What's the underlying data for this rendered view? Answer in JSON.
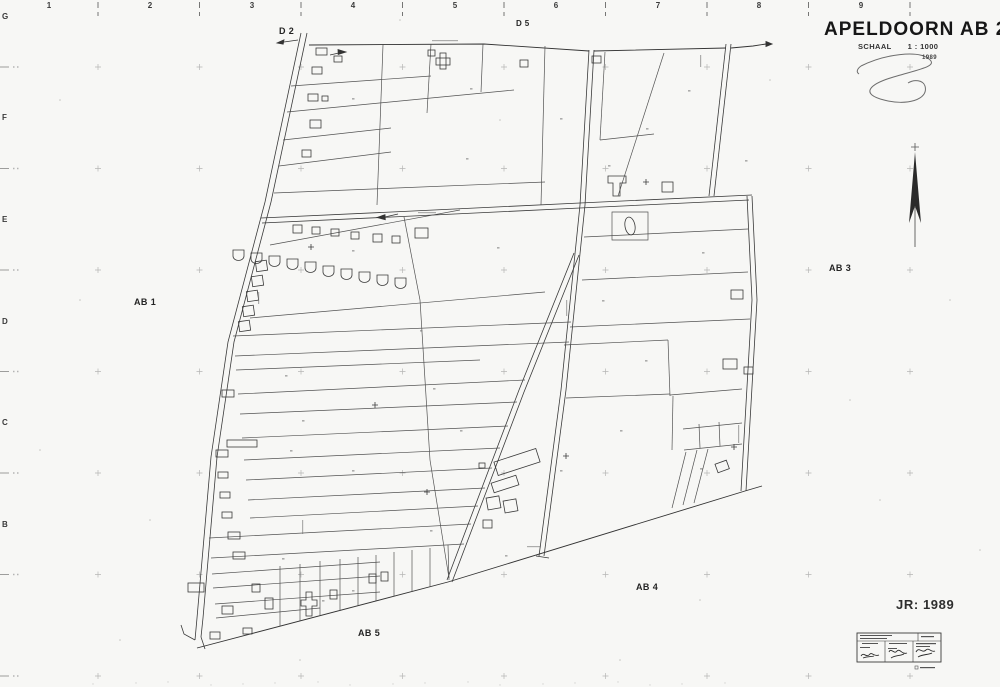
{
  "sheet": {
    "title": "APELDOORN AB 2",
    "scale_word": "SCHAAL",
    "scale_value": "1 : 1000",
    "scale_year": "1989",
    "revision_label": "JR: 1989"
  },
  "grid": {
    "top_numbers": [
      "1",
      "2",
      "3",
      "4",
      "5",
      "6",
      "7",
      "8",
      "9"
    ],
    "left_letters": [
      "G",
      "F",
      "E",
      "D",
      "C",
      "B"
    ]
  },
  "map_labels": {
    "d2": "D 2",
    "d5": "D 5",
    "ab1": "AB 1",
    "ab3": "AB 3",
    "ab4": "AB 4",
    "ab5": "AB 5"
  },
  "colors": {
    "paper": "#f7f7f5",
    "ink": "#2e2e2e",
    "faint_marks": "#8a8a8a"
  }
}
